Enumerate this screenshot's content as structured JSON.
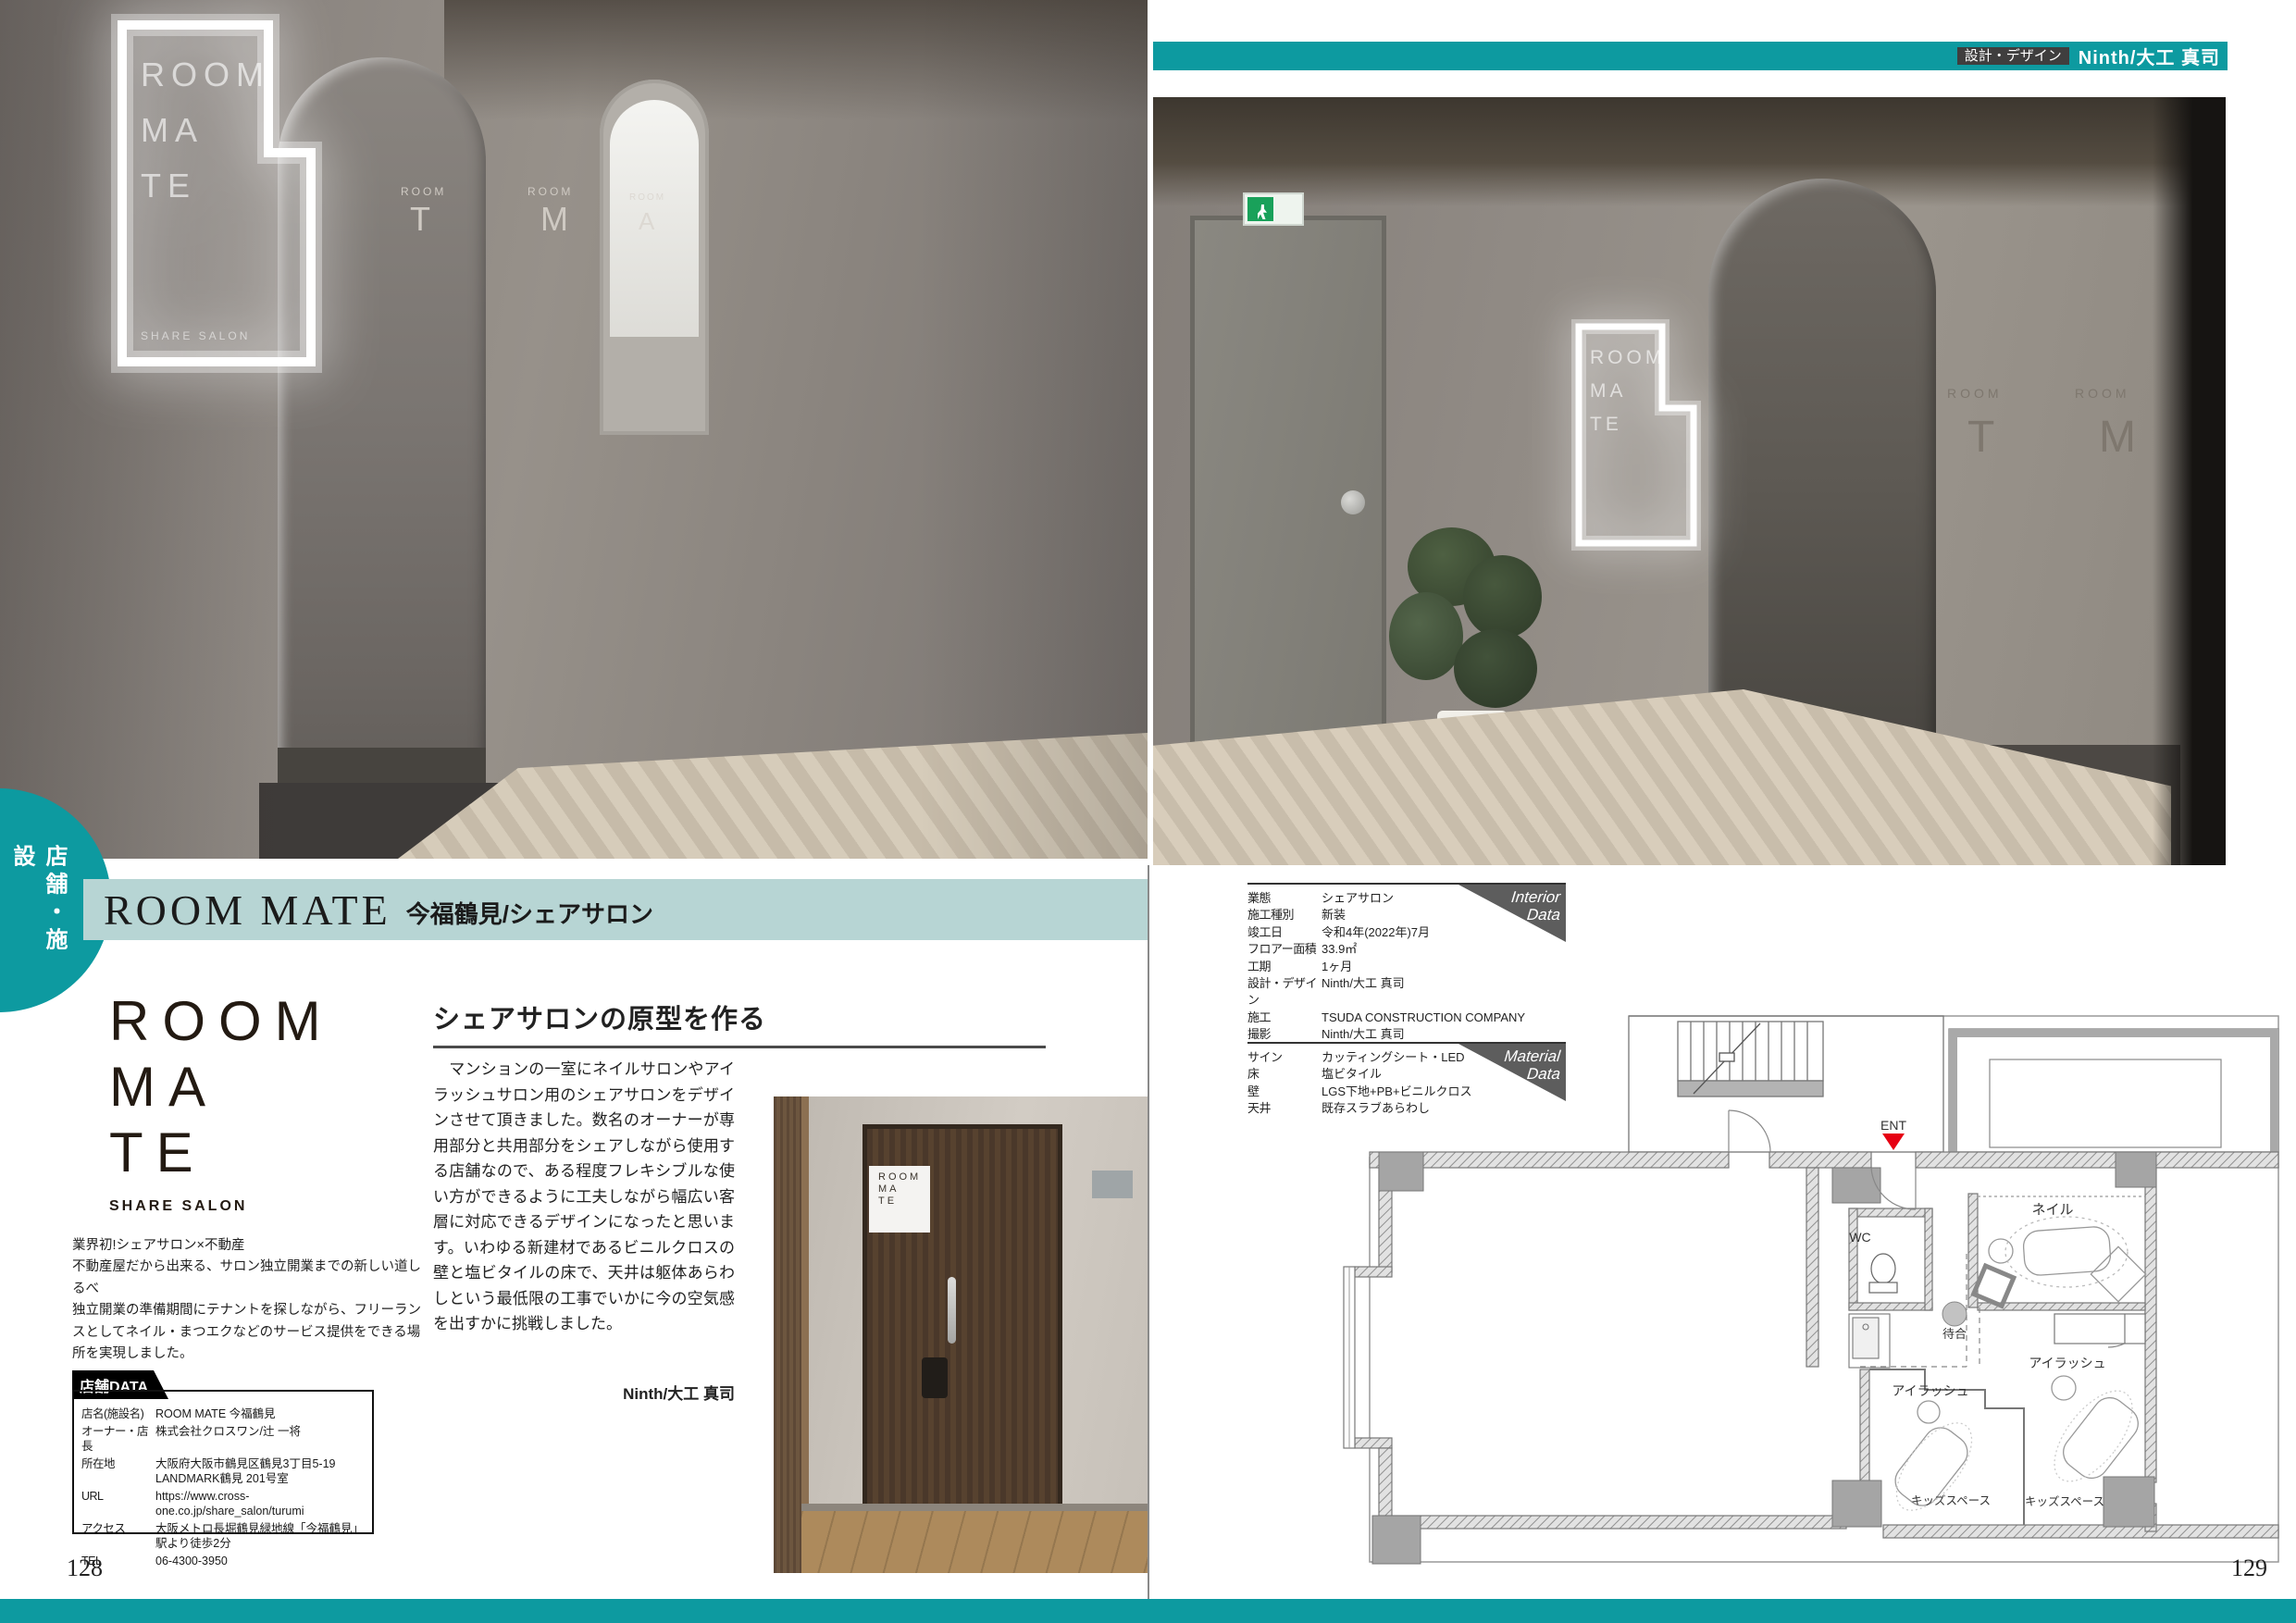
{
  "top_bar": {
    "tag": "設計・デザイン",
    "credit": "Ninth/大工 真司"
  },
  "side_tab": {
    "label": "店舗・施設"
  },
  "page_numbers": {
    "left": "128",
    "right": "129"
  },
  "title_bar": {
    "en": "ROOM MATE",
    "jp": "今福鶴見/シェアサロン"
  },
  "logo": {
    "line1": "ROOM",
    "line2": "MA",
    "line3": "TE",
    "sub": "SHARE SALON"
  },
  "intro": {
    "line1": "業界初!シェアサロン×不動産",
    "line2": "不動産屋だから出来る、サロン独立開業までの新しい道しるべ",
    "line3": "独立開業の準備期間にテナントを探しながら、フリーランスとしてネイル・まつエクなどのサービス提供をできる場所を実現しました。"
  },
  "shop_data": {
    "header": "店舗DATA",
    "rows": [
      {
        "label": "店名(施設名)",
        "value": "ROOM MATE 今福鶴見"
      },
      {
        "label": "オーナー・店長",
        "value": "株式会社クロスワン/辻 一将"
      },
      {
        "label": "所在地",
        "value": "大阪府大阪市鶴見区鶴見3丁目5-19 LANDMARK鶴見 201号室"
      },
      {
        "label": "URL",
        "value": "https://www.cross-one.co.jp/share_salon/turumi"
      },
      {
        "label": "アクセス",
        "value": "大阪メトロ長堀鶴見緑地線「今福鶴見」駅より徒歩2分"
      },
      {
        "label": "TEL",
        "value": "06-4300-3950"
      }
    ]
  },
  "article": {
    "heading": "シェアサロンの原型を作る",
    "body": "　マンションの一室にネイルサロンやアイラッシュサロン用のシェアサロンをデザインさせて頂きました。数名のオーナーが専用部分と共用部分をシェアしながら使用する店舗なので、ある程度フレキシブルな使い方ができるように工夫しながら幅広い客層に対応できるデザインになったと思います。いわゆる新建材であるビニルクロスの壁と塩ビタイルの床で、天井は躯体あらわしという最低限の工事でいかに今の空気感を出すかに挑戦しました。",
    "byline": "Ninth/大工 真司"
  },
  "interior_data": {
    "badge_top": "Interior",
    "badge_bottom": "Data",
    "rows": [
      {
        "label": "業態",
        "value": "シェアサロン"
      },
      {
        "label": "施工種別",
        "value": "新装"
      },
      {
        "label": "竣工日",
        "value": "令和4年(2022年)7月"
      },
      {
        "label": "フロアー面積",
        "value": "33.9㎡"
      },
      {
        "label": "工期",
        "value": "1ヶ月"
      },
      {
        "label": "設計・デザイン",
        "value": "Ninth/大工 真司"
      },
      {
        "label": "施工",
        "value": "TSUDA CONSTRUCTION COMPANY"
      },
      {
        "label": "撮影",
        "value": "Ninth/大工 真司"
      }
    ]
  },
  "material_data": {
    "badge_top": "Material",
    "badge_bottom": "Data",
    "rows": [
      {
        "label": "サイン",
        "value": "カッティングシート・LED"
      },
      {
        "label": "床",
        "value": "塩ビタイル"
      },
      {
        "label": "壁",
        "value": "LGS下地+PB+ビニルクロス"
      },
      {
        "label": "天井",
        "value": "既存スラブあらわし"
      }
    ]
  },
  "floor_plan": {
    "labels": {
      "ent": "ENT",
      "wc": "WC",
      "waiting": "待合",
      "nail": "ネイル",
      "eyelash_left": "アイラッシュ",
      "eyelash_right": "アイラッシュ",
      "kids_left": "キッズスペース",
      "kids_right": "キッズスペース"
    }
  },
  "photo_left": {
    "sign_line1": "ROOM",
    "sign_line2": "MA",
    "sign_line3": "TE",
    "sign_sub": "SHARE SALON",
    "letters": {
      "room1": "ROOM",
      "t": "T",
      "room2": "ROOM",
      "m": "M",
      "room3": "ROOM",
      "a": "A"
    }
  },
  "photo_right": {
    "sign_line1": "ROOM",
    "sign_line2": "MA",
    "sign_line3": "TE",
    "letters": {
      "room1": "ROOM",
      "room2": "ROOM",
      "t": "T",
      "m": "M"
    }
  },
  "door_photo": {
    "plate_line1": "ROOM",
    "plate_line2": "MA",
    "plate_line3": "TE"
  },
  "colors": {
    "teal": "#0d9aa0",
    "pale_teal": "#b7d5d4",
    "badge_gray": "#5d5d5d",
    "ent_red": "#e60012"
  }
}
